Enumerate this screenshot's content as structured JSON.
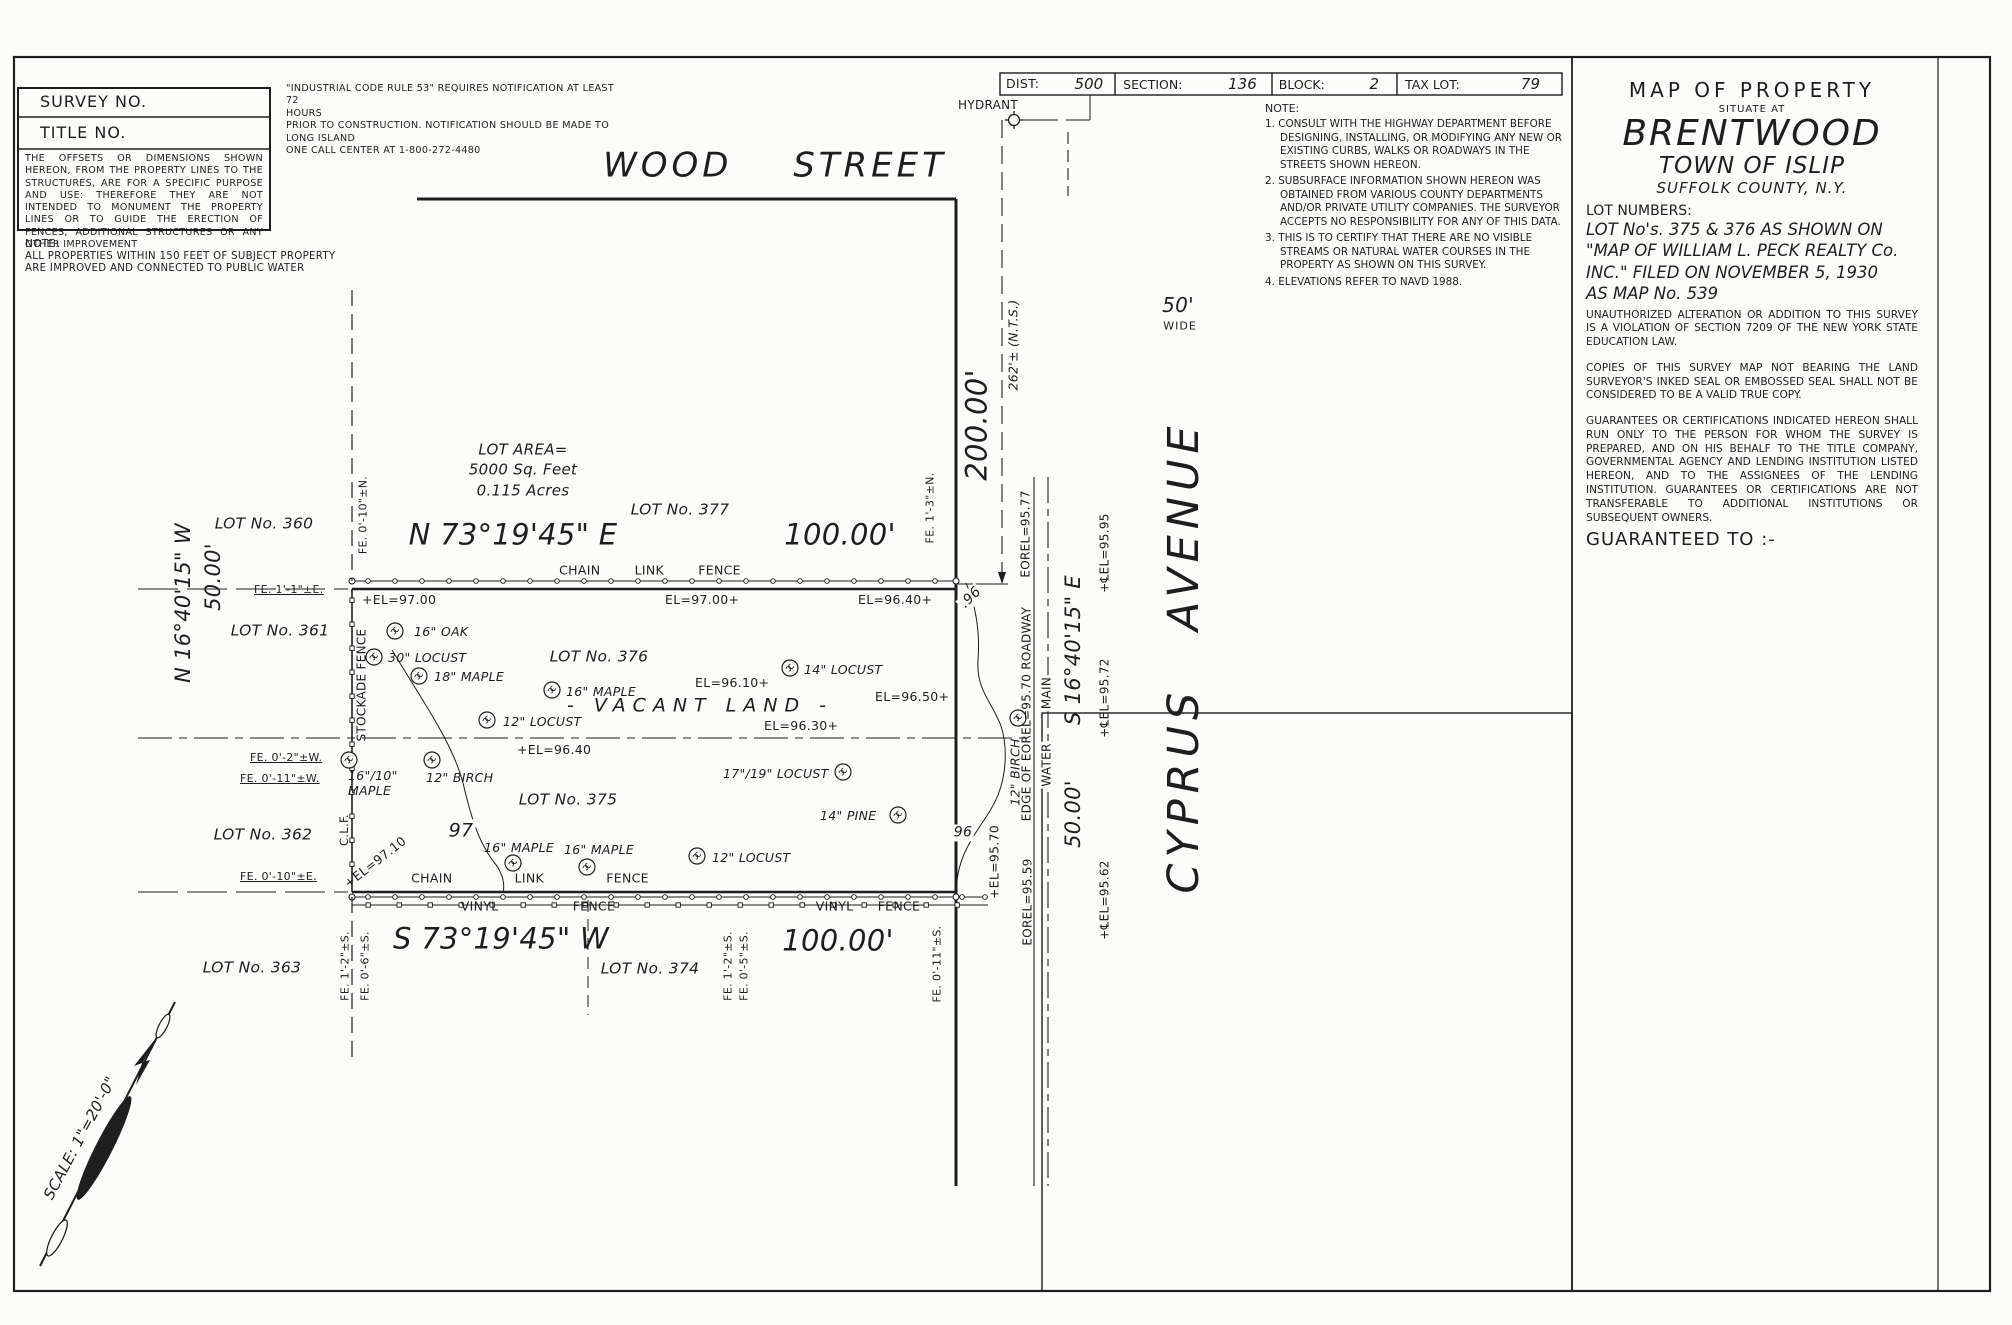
{
  "colors": {
    "ink": "#1e1e1e",
    "paper": "#fcfcfa"
  },
  "corner_box": {
    "survey_no": "SURVEY NO.",
    "title_no": "TITLE NO.",
    "offsets_note": "THE OFFSETS OR DIMENSIONS SHOWN HEREON, FROM THE PROPERTY LINES TO THE STRUCTURES, ARE FOR A SPECIFIC PURPOSE AND USE: THEREFORE THEY ARE NOT INTENDED TO MONUMENT THE PROPERTY LINES OR TO GUIDE THE ERECTION OF FENCES, ADDITIONAL STRUCTURES OR ANY OTHER IMPROVEMENT",
    "note_label": "NOTE:",
    "water_note": "ALL PROPERTIES WITHIN 150 FEET OF SUBJECT PROPERTY\nARE IMPROVED AND CONNECTED TO PUBLIC WATER"
  },
  "industrial_note": "\"INDUSTRIAL CODE RULE 53\" REQUIRES NOTIFICATION AT LEAST 72\nHOURS\nPRIOR TO CONSTRUCTION. NOTIFICATION SHOULD BE MADE TO\nLONG ISLAND\nONE CALL CENTER AT 1-800-272-4480",
  "tax_bar": {
    "cells": [
      {
        "label": "DIST:",
        "value": "500"
      },
      {
        "label": "SECTION:",
        "value": "136"
      },
      {
        "label": "BLOCK:",
        "value": "2"
      },
      {
        "label": "TAX LOT:",
        "value": "79"
      }
    ]
  },
  "survey_notes": {
    "label": "NOTE:",
    "items": [
      "1. CONSULT WITH THE HIGHWAY DEPARTMENT BEFORE DESIGNING, INSTALLING, OR MODIFYING ANY NEW OR EXISTING CURBS, WALKS OR ROADWAYS IN THE STREETS SHOWN HEREON.",
      "2. SUBSURFACE INFORMATION SHOWN HEREON WAS OBTAINED FROM VARIOUS COUNTY DEPARTMENTS AND/OR PRIVATE UTILITY COMPANIES. THE SURVEYOR ACCEPTS NO RESPONSIBILITY FOR ANY OF THIS DATA.",
      "3. THIS IS TO CERTIFY THAT THERE ARE NO VISIBLE STREAMS OR NATURAL WATER COURSES IN THE PROPERTY AS SHOWN ON THIS SURVEY.",
      "4. ELEVATIONS REFER TO NAVD 1988."
    ]
  },
  "title_block": {
    "line1": "MAP  OF  PROPERTY",
    "line2": "SITUATE AT",
    "city": "BRENTWOOD",
    "town": "TOWN OF ISLIP",
    "county": "SUFFOLK COUNTY, N.Y.",
    "lot_numbers_label": "LOT  NUMBERS:",
    "lot_numbers": "LOT No's. 375 & 376 AS SHOWN ON\n\"MAP OF WILLIAM L. PECK REALTY Co.\nINC.\" FILED ON NOVEMBER 5, 1930\nAS MAP No. 539",
    "para_alteration": "UNAUTHORIZED ALTERATION OR ADDITION TO THIS SURVEY IS A VIOLATION OF SECTION 7209 OF THE NEW YORK STATE EDUCATION LAW.",
    "para_copies": "COPIES OF THIS SURVEY MAP NOT BEARING THE LAND SURVEYOR'S INKED SEAL OR EMBOSSED SEAL SHALL NOT BE CONSIDERED TO BE A VALID TRUE COPY.",
    "para_guarantees": "GUARANTEES OR CERTIFICATIONS INDICATED HEREON SHALL RUN ONLY TO THE PERSON FOR WHOM THE SURVEY IS PREPARED, AND ON HIS BEHALF TO THE TITLE COMPANY, GOVERNMENTAL AGENCY AND LENDING INSTITUTION LISTED HEREON, AND TO THE ASSIGNEES OF THE LENDING INSTITUTION. GUARANTEES OR CERTIFICATIONS ARE NOT TRANSFERABLE TO ADDITIONAL INSTITUTIONS OR SUBSEQUENT OWNERS.",
    "guaranteed_to": "GUARANTEED   TO :-"
  },
  "drawing": {
    "streets": {
      "wood": "WOOD   STREET",
      "cyprus": "CYPRUS   AVENUE",
      "width": "50'",
      "wide": "WIDE"
    },
    "hydrant_label": "HYDRANT",
    "scale_label": "SCALE: 1\"=20'-0\"",
    "lot_area": "LOT AREA=\n5000 Sq. Feet\n0.115 Acres",
    "vacant_land": "- VACANT   LAND -",
    "bearings": {
      "north": "N 73°19'45\" E",
      "south": "S 73°19'45\" W",
      "east": "S 16°40'15\" E",
      "west": "N 16°40'15\" W",
      "dist_north": "100.00'",
      "dist_south": "100.00'",
      "dist_east": "50.00'",
      "dist_west": "50.00'",
      "frontage": "200.00'",
      "nts": "262'± (N.T.S.)"
    },
    "lots": [
      "LOT No. 360",
      "LOT No. 361",
      "LOT No. 362",
      "LOT No. 363",
      "LOT No. 374",
      "LOT No. 375",
      "LOT No. 376",
      "LOT No. 377"
    ],
    "trees": [
      "16\" OAK",
      "30\" LOCUST",
      "18\" MAPLE",
      "16\" MAPLE",
      "12\" LOCUST",
      "14\" LOCUST",
      "17\"/19\" LOCUST",
      "14\" PINE",
      "16\"/10\"\nMAPLE",
      "12\" BIRCH",
      "16\" MAPLE",
      "16\" MAPLE",
      "12\" LOCUST",
      "12\" BIRCH"
    ],
    "elevations": [
      "+EL=97.00",
      "EL=97.00+",
      "EL=96.40+",
      "EL=96.10+",
      "EL=96.50+",
      "EL=96.30+",
      "+EL=96.40",
      "+EL=97.10",
      "+EL=95.70",
      "EOREL=95.77",
      "EDGE OF  EOREL=95.70  ROADWAY",
      "EOREL=95.59",
      "WATER",
      "MAIN",
      "+℄EL=95.95",
      "+℄EL=95.72",
      "+℄EL=95.62"
    ],
    "contours": [
      "97",
      ".96",
      "96"
    ],
    "fence_offsets": [
      "FE. 0'-10\"±N.",
      "FE. 1'-3\"±N.",
      "FE. 1'-1\"±E.",
      "FE. 0'-2\"±W.",
      "FE. 0'-11\"±W.",
      "FE. 0'-10\"±E.",
      "FE. 1'-2\"±S.",
      "FE. 0'-6\"±S.",
      "FE. 1'-2\"±S.",
      "FE. 0'-5\"±S.",
      "FE. 0'-11\"±S."
    ],
    "fence_types": [
      "CHAIN  LINK  FENCE",
      "CHAIN  LINK  FENCE",
      "VINYL  FENCE",
      "VINYL  FENCE",
      "STOCKADE FENCE",
      "C.L.F."
    ]
  }
}
